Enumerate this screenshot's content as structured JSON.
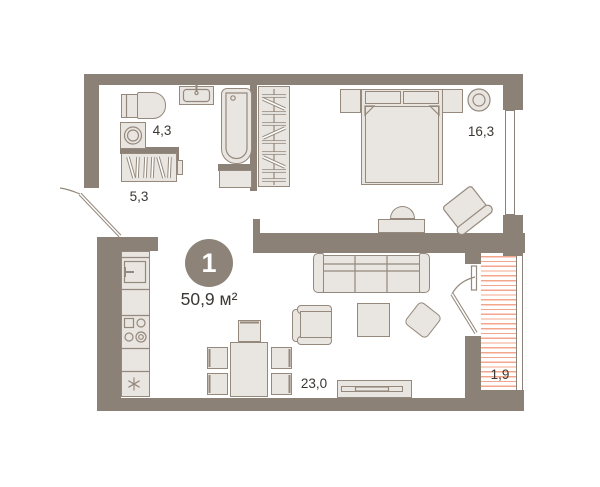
{
  "floorplan": {
    "unit": {
      "number": "1",
      "area": "50,9 м²"
    },
    "rooms": [
      {
        "name": "bathroom",
        "area": "4,3"
      },
      {
        "name": "hallway",
        "area": "5,3"
      },
      {
        "name": "bedroom",
        "area": "16,3"
      },
      {
        "name": "living-kitchen",
        "area": "23,0"
      },
      {
        "name": "balcony",
        "area": "1,9"
      }
    ],
    "colors": {
      "wall": "#8B8177",
      "furniture_fill": "#E9E5E0",
      "furniture_stroke": "#95897D",
      "balcony_hatch": "#F2A78C",
      "label_text": "#3B3834",
      "badge_bg": "#8D8378",
      "badge_text": "#FFFFFF"
    },
    "furniture_icons": [
      "toilet",
      "washing-machine",
      "bathroom-sink",
      "bathtub",
      "bath-cabinet",
      "hall-closet",
      "wardrobe",
      "double-bed",
      "nightstand",
      "mirror",
      "armchair",
      "desk",
      "desk-chair",
      "sofa",
      "coffee-table",
      "pouf",
      "dining-table",
      "dining-chair",
      "tv-stand",
      "kitchen-sink",
      "stove",
      "fridge"
    ]
  }
}
